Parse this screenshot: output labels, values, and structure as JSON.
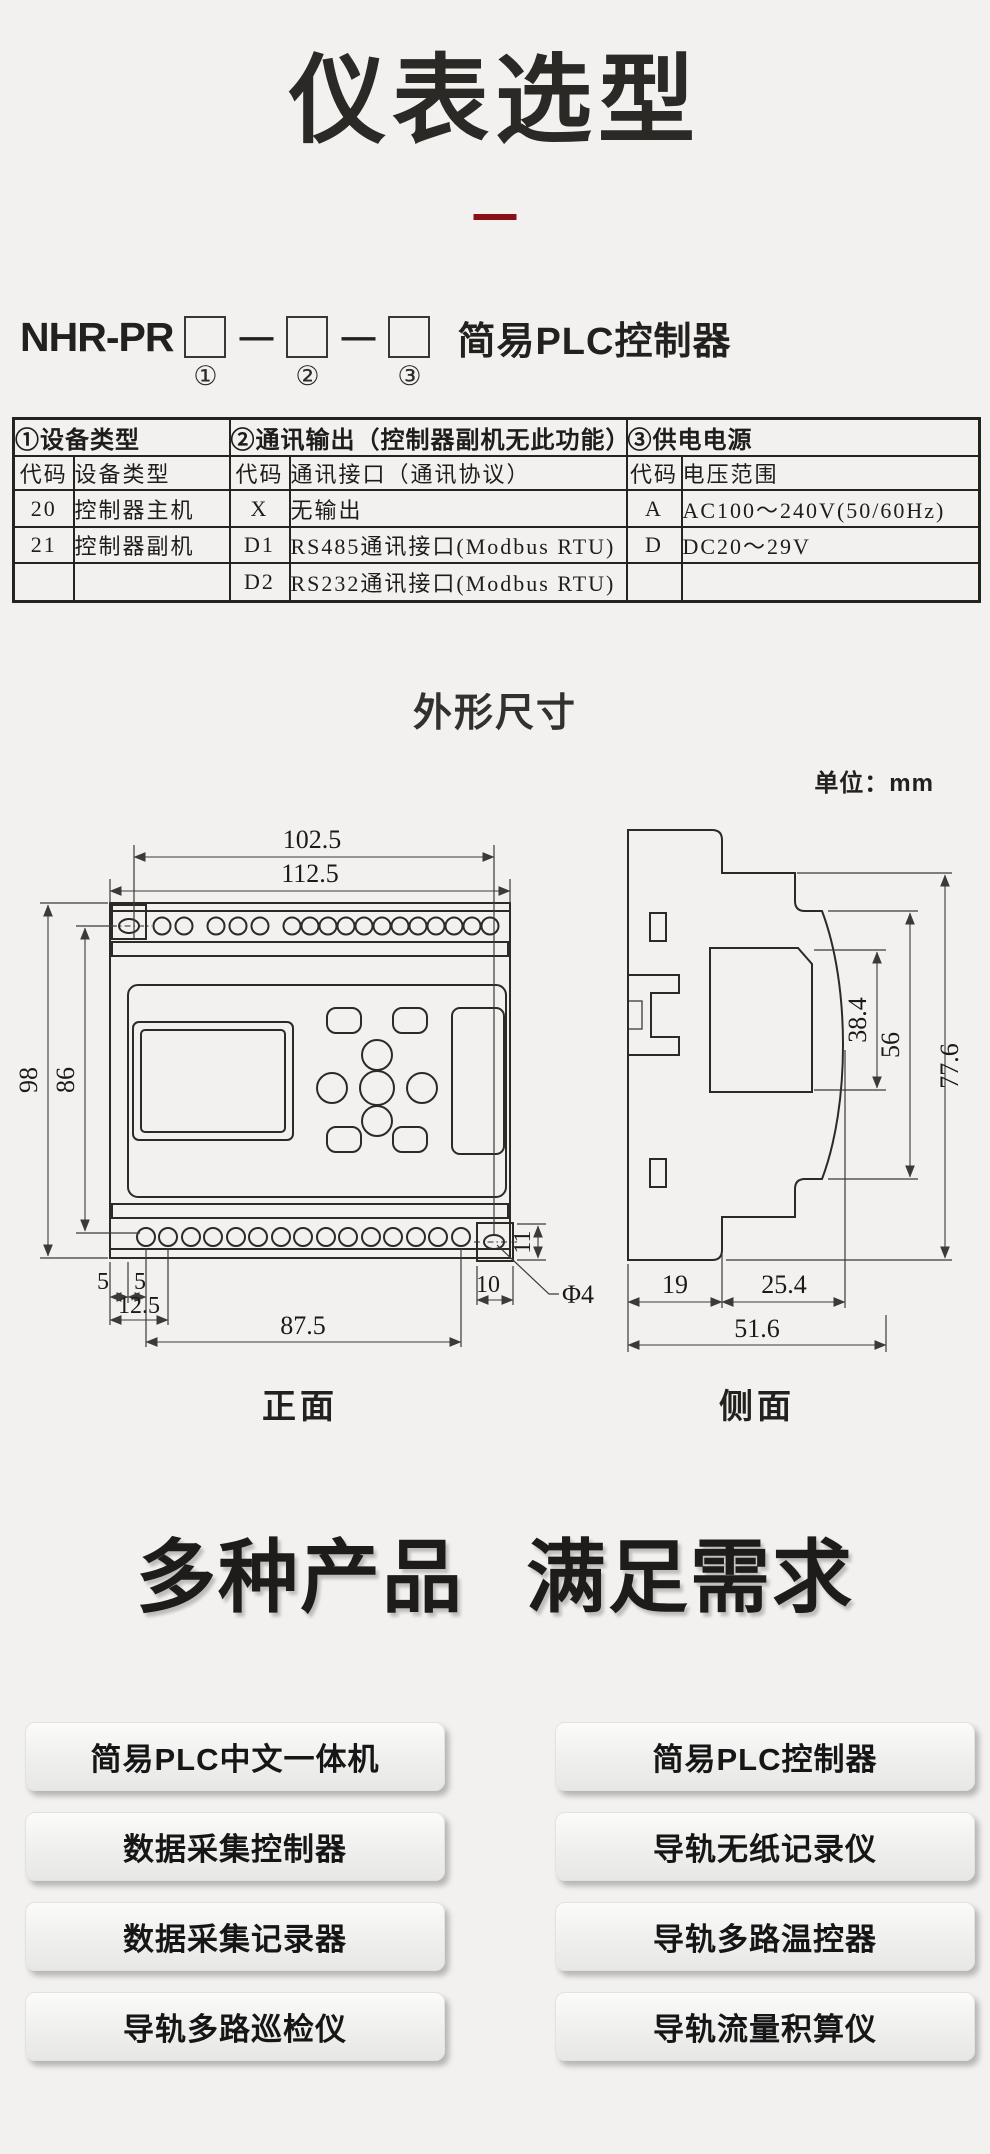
{
  "page": {
    "background": "#f2f1ef",
    "accent_red": "#8a1016",
    "line_color": "#2d2a26"
  },
  "header": {
    "title": "仪表选型"
  },
  "model": {
    "prefix": "NHR-PR",
    "dash": "—",
    "suffix": "简易PLC控制器",
    "marks": [
      "①",
      "②",
      "③"
    ]
  },
  "selection_table": {
    "sections": [
      {
        "title": "①设备类型",
        "code_header": "代码",
        "value_header": "设备类型",
        "rows": [
          {
            "code": "20",
            "value": "控制器主机"
          },
          {
            "code": "21",
            "value": "控制器副机"
          },
          {
            "code": "",
            "value": ""
          }
        ]
      },
      {
        "title": "②通讯输出（控制器副机无此功能）",
        "code_header": "代码",
        "value_header": "通讯接口（通讯协议）",
        "rows": [
          {
            "code": "X",
            "value": "无输出"
          },
          {
            "code": "D1",
            "value": "RS485通讯接口(Modbus RTU)"
          },
          {
            "code": "D2",
            "value": "RS232通讯接口(Modbus RTU)"
          }
        ]
      },
      {
        "title": "③供电电源",
        "code_header": "代码",
        "value_header": "电压范围",
        "rows": [
          {
            "code": "A",
            "value": "AC100～240V(50/60Hz)"
          },
          {
            "code": "D",
            "value": "DC20～29V"
          },
          {
            "code": "",
            "value": ""
          }
        ]
      }
    ]
  },
  "dimensions": {
    "heading": "外形尺寸",
    "unit_label": "单位：mm",
    "front": {
      "label": "正面",
      "width_top": "102.5",
      "width_full": "112.5",
      "height_full": "98",
      "height_inner": "86",
      "offset_a": "5",
      "offset_b": "5",
      "offset_c": "12.5",
      "span_bottom": "87.5",
      "ear_width": "10",
      "ear_height": "11",
      "hole_dia": "Φ4"
    },
    "side": {
      "label": "侧面",
      "display_height": "38.4",
      "front_height": "56",
      "total_height": "77.6",
      "back_depth": "19",
      "front_depth": "25.4",
      "total_depth": "51.6"
    }
  },
  "products": {
    "heading": [
      "多种产品",
      "满足需求"
    ],
    "left": [
      "简易PLC中文一体机",
      "数据采集控制器",
      "数据采集记录器",
      "导轨多路巡检仪"
    ],
    "right": [
      "简易PLC控制器",
      "导轨无纸记录仪",
      "导轨多路温控器",
      "导轨流量积算仪"
    ]
  }
}
